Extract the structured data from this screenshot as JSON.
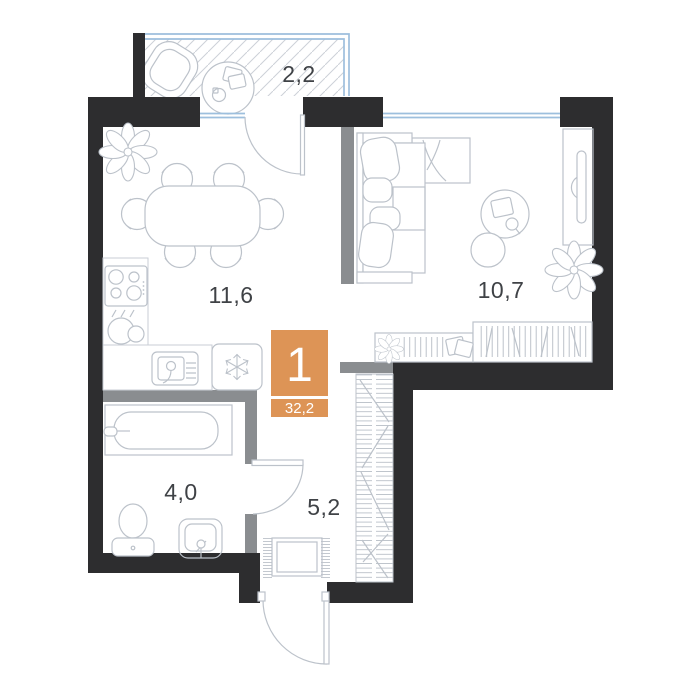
{
  "plan": {
    "unit": {
      "rooms_count": "1",
      "total_area": "32,2"
    },
    "rooms": [
      {
        "id": "balcony",
        "area": "2,2"
      },
      {
        "id": "kitchen-dining",
        "area": "11,6"
      },
      {
        "id": "living-room",
        "area": "10,7"
      },
      {
        "id": "bathroom",
        "area": "4,0"
      },
      {
        "id": "hallway",
        "area": "5,2"
      }
    ],
    "icons": {
      "fridge": "snowflake-icon",
      "plants": "flower-icon"
    },
    "colors": {
      "accent": "#DD9456",
      "wall": "#2D2D2F",
      "partition": "#8A8D90",
      "furniture_line": "#BCC2CA",
      "glazing": "#9DBFDD",
      "label": "#3F4246"
    }
  }
}
